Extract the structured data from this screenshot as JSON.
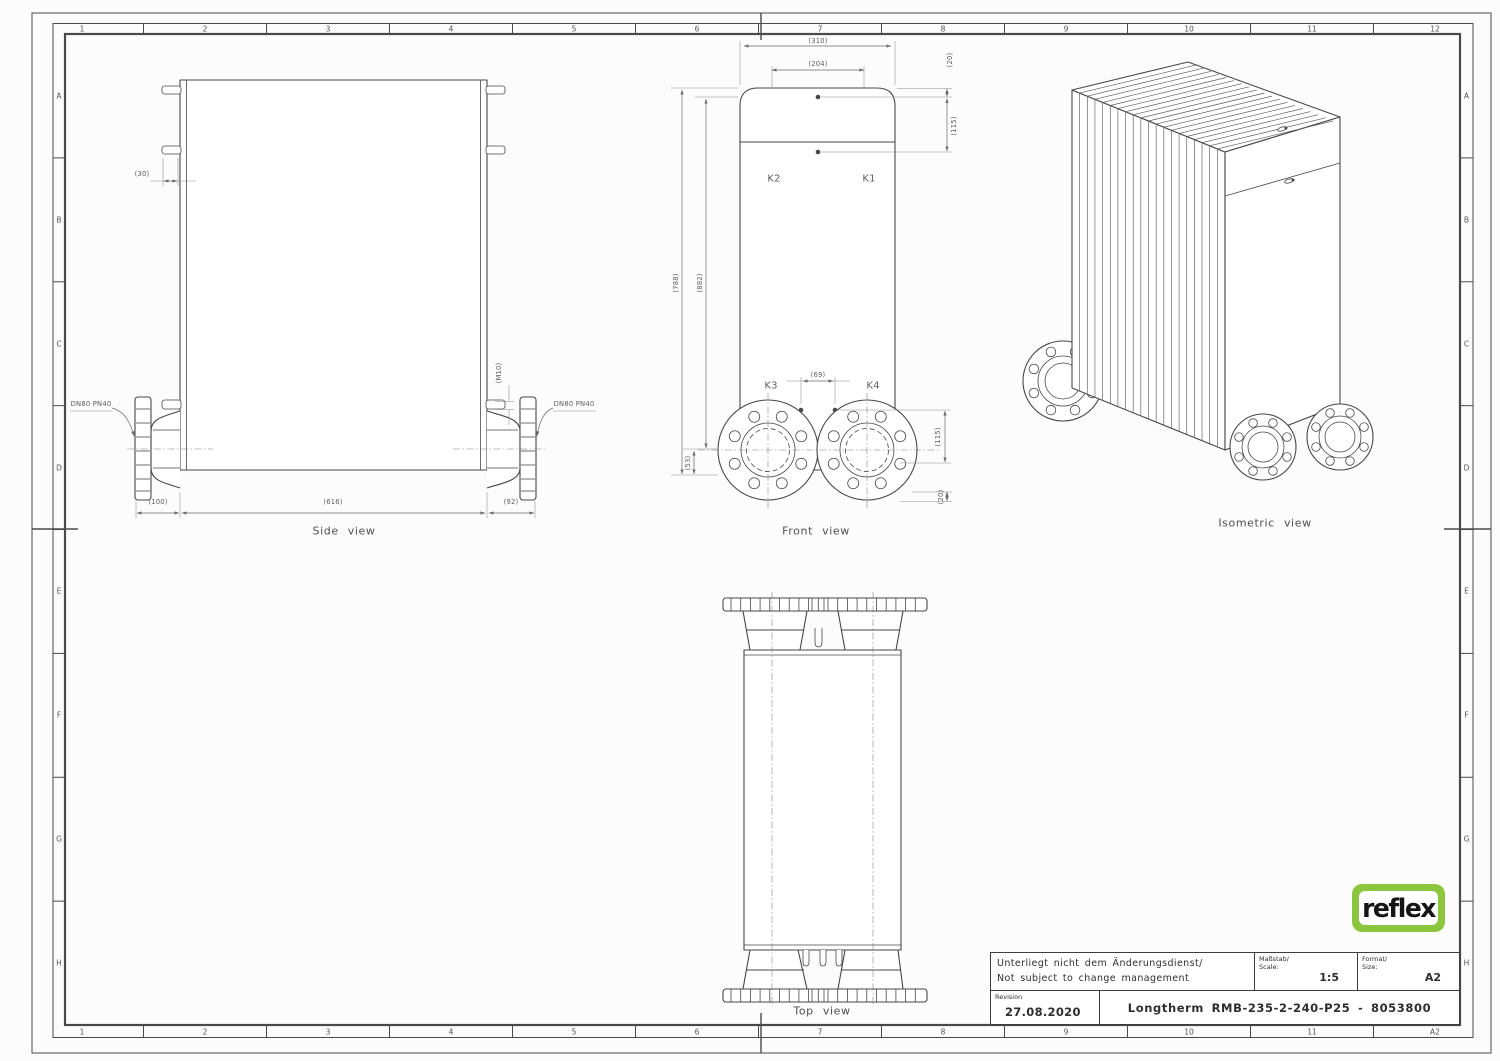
{
  "sheet": {
    "document_type": "Technical drawing",
    "product": "Longtherm RMB-235-2-240-P25 - 8053800"
  },
  "colors": {
    "line": "#474747",
    "dimension": "#6a6a6a",
    "logo_green": "#8cc63e",
    "background": "#fcfcfc"
  },
  "grid": {
    "top": [
      "1",
      "2",
      "3",
      "4",
      "5",
      "6",
      "7",
      "8",
      "9",
      "10",
      "11",
      "12"
    ],
    "bottom": [
      "1",
      "2",
      "3",
      "4",
      "5",
      "6",
      "7",
      "8",
      "9",
      "10",
      "11",
      "A2"
    ],
    "left": [
      "A",
      "B",
      "C",
      "D",
      "E",
      "F",
      "G",
      "H"
    ],
    "right": [
      "A",
      "B",
      "C",
      "D",
      "E",
      "F",
      "G",
      "H"
    ]
  },
  "labels": [
    {
      "n": "dim-30",
      "t": "(30)",
      "x": 142,
      "y": 174
    },
    {
      "n": "dim-m10",
      "t": "(M10)",
      "x": 499,
      "y": 373,
      "r": 1
    },
    {
      "n": "flange-label-left",
      "t": "DN80 PN40",
      "x": 91,
      "y": 404
    },
    {
      "n": "flange-label-right",
      "t": "DN80 PN40",
      "x": 574,
      "y": 404
    },
    {
      "n": "dim-100",
      "t": "(100)",
      "x": 158,
      "y": 502
    },
    {
      "n": "dim-616",
      "t": "(616)",
      "x": 333,
      "y": 502
    },
    {
      "n": "dim-92",
      "t": "(92)",
      "x": 511,
      "y": 502
    },
    {
      "n": "side-view-label",
      "t": "Side view",
      "x": 344,
      "y": 531,
      "fs": 11
    },
    {
      "n": "dim-310",
      "t": "(310)",
      "x": 818,
      "y": 41
    },
    {
      "n": "dim-204",
      "t": "(204)",
      "x": 818,
      "y": 64
    },
    {
      "n": "dim-20-top",
      "t": "(20)",
      "x": 950,
      "y": 60,
      "r": 1
    },
    {
      "n": "dim-115-top",
      "t": "(115)",
      "x": 954,
      "y": 126,
      "r": 1
    },
    {
      "n": "port-k2",
      "t": "K2",
      "x": 774,
      "y": 179,
      "fs": 10
    },
    {
      "n": "port-k1",
      "t": "K1",
      "x": 869,
      "y": 179,
      "fs": 10
    },
    {
      "n": "dim-788",
      "t": "(788)",
      "x": 676,
      "y": 283,
      "r": 1
    },
    {
      "n": "dim-882",
      "t": "(882)",
      "x": 700,
      "y": 283,
      "r": 1
    },
    {
      "n": "port-k3",
      "t": "K3",
      "x": 771,
      "y": 386,
      "fs": 10
    },
    {
      "n": "port-k4",
      "t": "K4",
      "x": 873,
      "y": 386,
      "fs": 10
    },
    {
      "n": "dim-69",
      "t": "(69)",
      "x": 818,
      "y": 375
    },
    {
      "n": "dim-53",
      "t": "(53)",
      "x": 688,
      "y": 463,
      "r": 1
    },
    {
      "n": "dim-115-bottom",
      "t": "(115)",
      "x": 938,
      "y": 437,
      "r": 1
    },
    {
      "n": "dim-20-bottom",
      "t": "(20)",
      "x": 941,
      "y": 497,
      "r": 1
    },
    {
      "n": "front-view-label",
      "t": "Front view",
      "x": 816,
      "y": 531,
      "fs": 11
    },
    {
      "n": "top-view-label",
      "t": "Top view",
      "x": 822,
      "y": 1011,
      "fs": 11
    },
    {
      "n": "iso-view-label",
      "t": "Isometric view",
      "x": 1265,
      "y": 523,
      "fs": 11
    }
  ],
  "title_block": {
    "note_line1": "Unterliegt nicht dem Änderungsdienst/",
    "note_line2": "Not subject to change management",
    "scale_label_de": "Maßstab/",
    "scale_label_en": "Scale:",
    "scale_value": "1:5",
    "format_label_de": "Format/",
    "format_label_en": "Size:",
    "format_value": "A2",
    "revision_label": "Revision",
    "revision_date": "27.08.2020",
    "drawing_title": "Longtherm RMB-235-2-240-P25 - 8053800"
  },
  "logo": {
    "text": "reflex",
    "green": "#8cc63e"
  }
}
